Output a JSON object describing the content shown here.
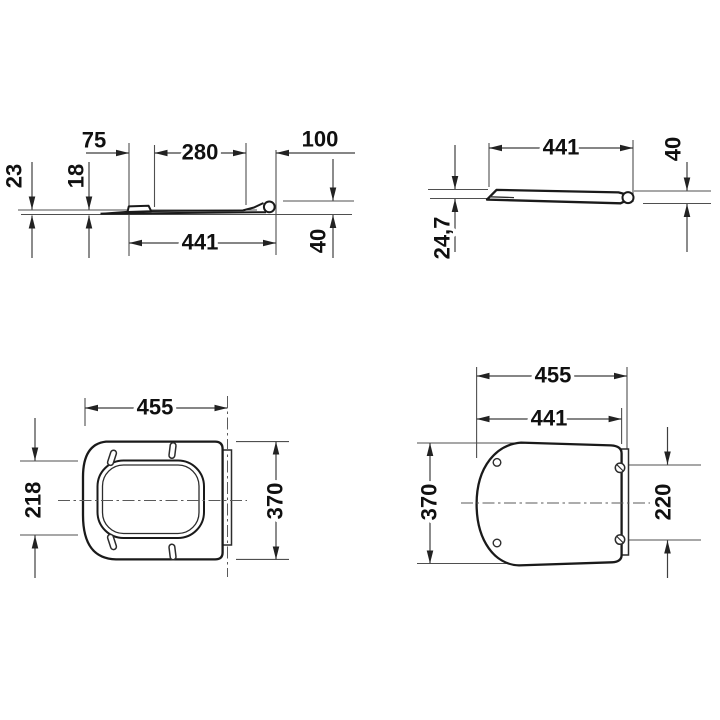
{
  "drawing": {
    "background": "#ffffff",
    "line_color": "#4f4f4f",
    "outline_color": "#1a1a1a",
    "text_color": "#101010",
    "views": {
      "seat_profile": {
        "dims": {
          "bumper_offset": "75",
          "center_span": "280",
          "rear_span": "100",
          "front_thickness": "23",
          "mid_thickness": "18",
          "overall_length": "441",
          "rear_height": "40"
        }
      },
      "lid_profile": {
        "dims": {
          "overall_length": "441",
          "rear_height": "40",
          "front_height": "24,7"
        }
      },
      "seat_plan": {
        "dims": {
          "overall_width": "455",
          "opening_depth": "218",
          "overall_depth": "370"
        }
      },
      "lid_plan": {
        "dims": {
          "overall_width": "455",
          "lid_width": "441",
          "overall_depth": "370",
          "hinge_hole_spacing": "220"
        }
      }
    }
  }
}
